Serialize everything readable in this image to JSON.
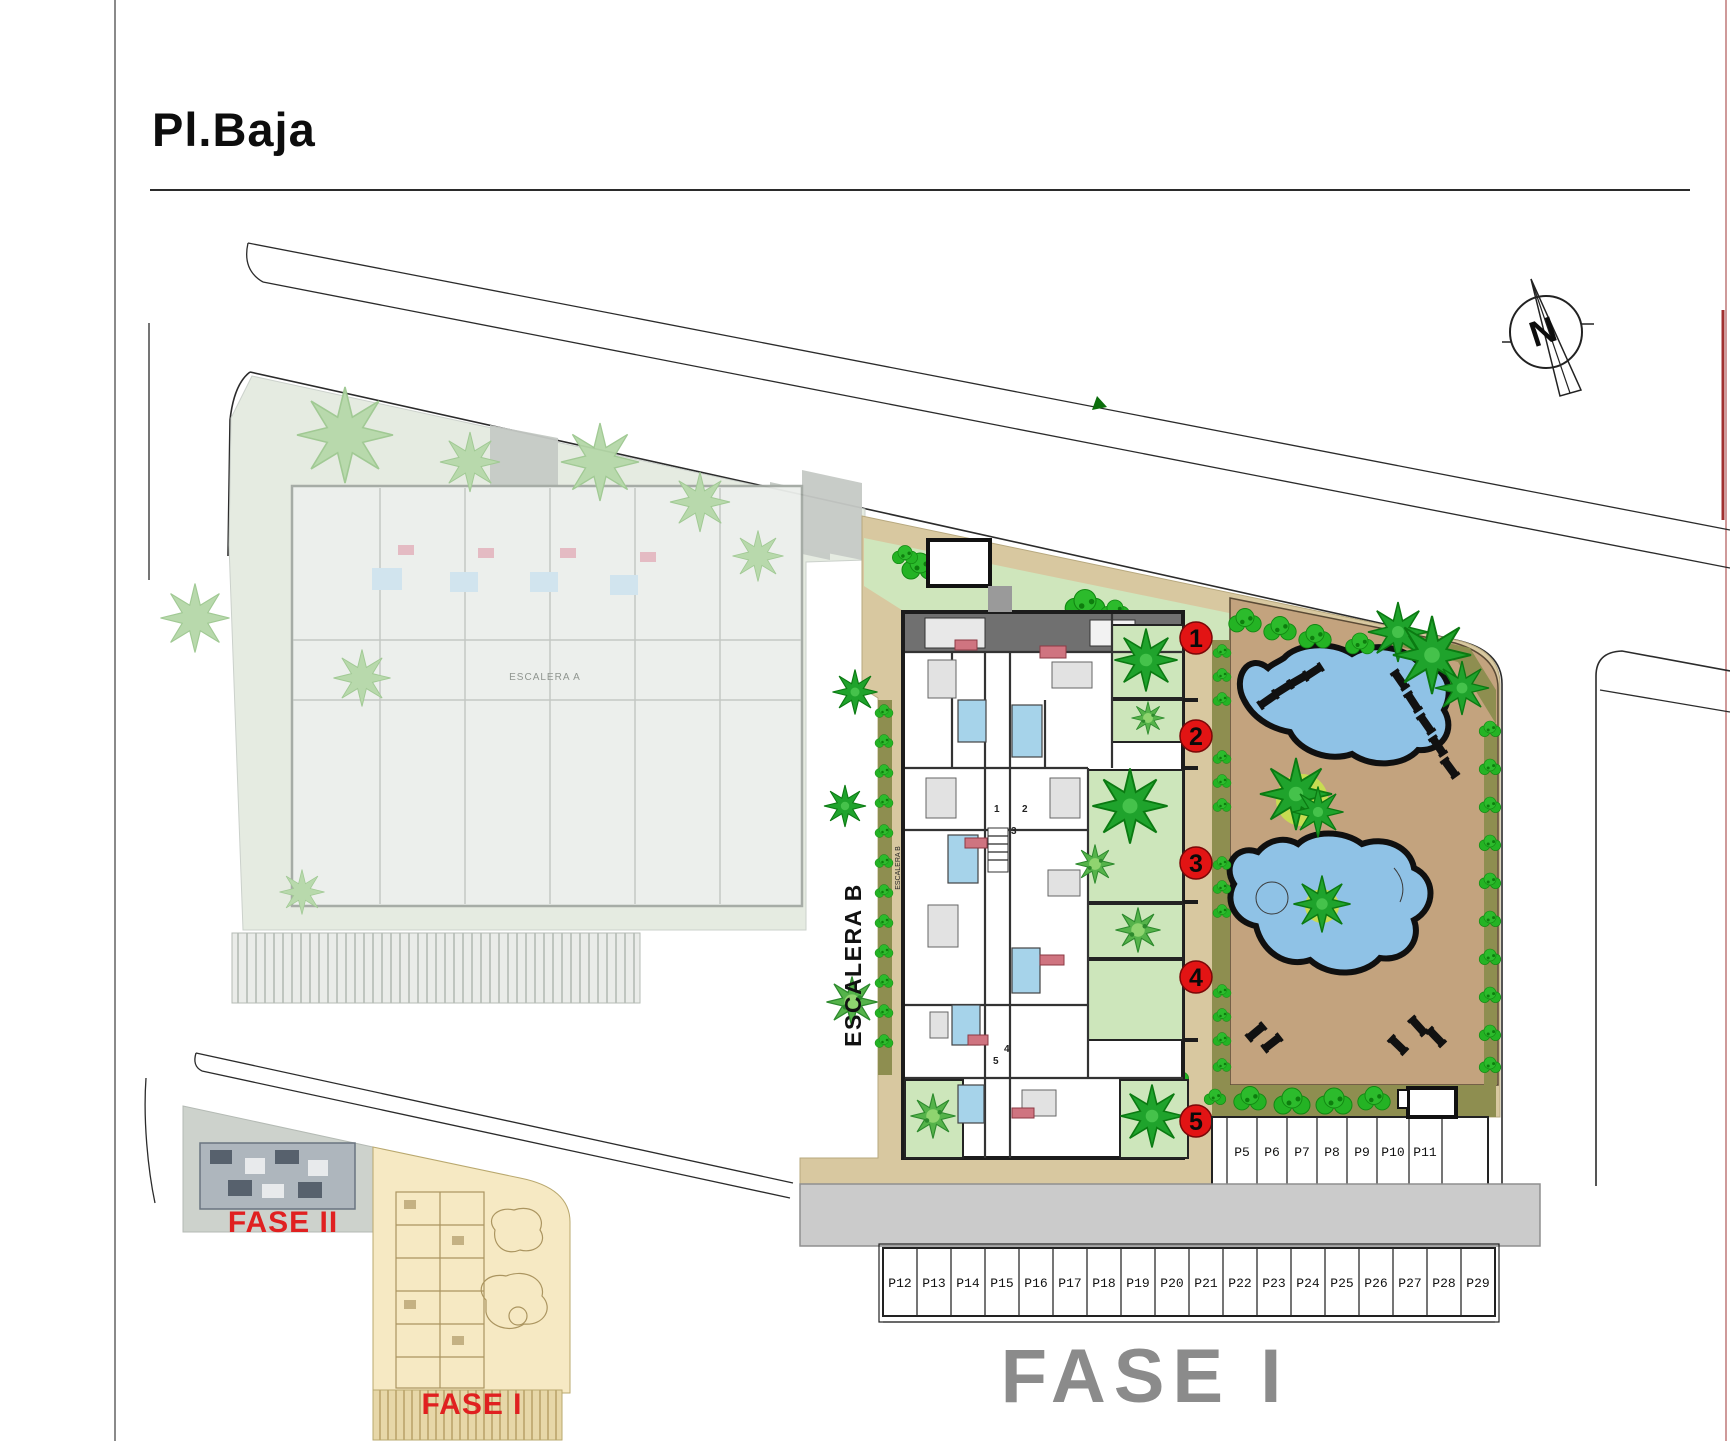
{
  "page": {
    "title": "Pl.Baja"
  },
  "compass": {
    "label": "N"
  },
  "labels": {
    "escalera_a": "ESCALERA A",
    "escalera_b": "ESCALERA B"
  },
  "units": {
    "markers": [
      "1",
      "2",
      "3",
      "4",
      "5"
    ],
    "plan_digits": [
      "1",
      "2",
      "3",
      "4",
      "5"
    ]
  },
  "parking": {
    "row_top": [
      "P5",
      "P6",
      "P7",
      "P8",
      "P9",
      "P10",
      "P11"
    ],
    "row_bottom": [
      "P12",
      "P13",
      "P14",
      "P15",
      "P16",
      "P17",
      "P18",
      "P19",
      "P20",
      "P21",
      "P22",
      "P23",
      "P24",
      "P25",
      "P26",
      "P27",
      "P28",
      "P29"
    ]
  },
  "phases": {
    "fase1_large": "FASE I"
  },
  "inset": {
    "fase2_label": "FASE II",
    "fase1_label": "FASE I"
  },
  "colors": {
    "marker_red": "#e21414",
    "pool_blue": "#8fc2e6",
    "terrace_tan": "#d8c8a0",
    "deck_tan": "#c3a37e",
    "hedge_green": "#1fa32c",
    "phase_text_gray": "#8b8b8b",
    "inset_yellow": "#f6e9c3",
    "phase_label_red": "#e02020"
  }
}
